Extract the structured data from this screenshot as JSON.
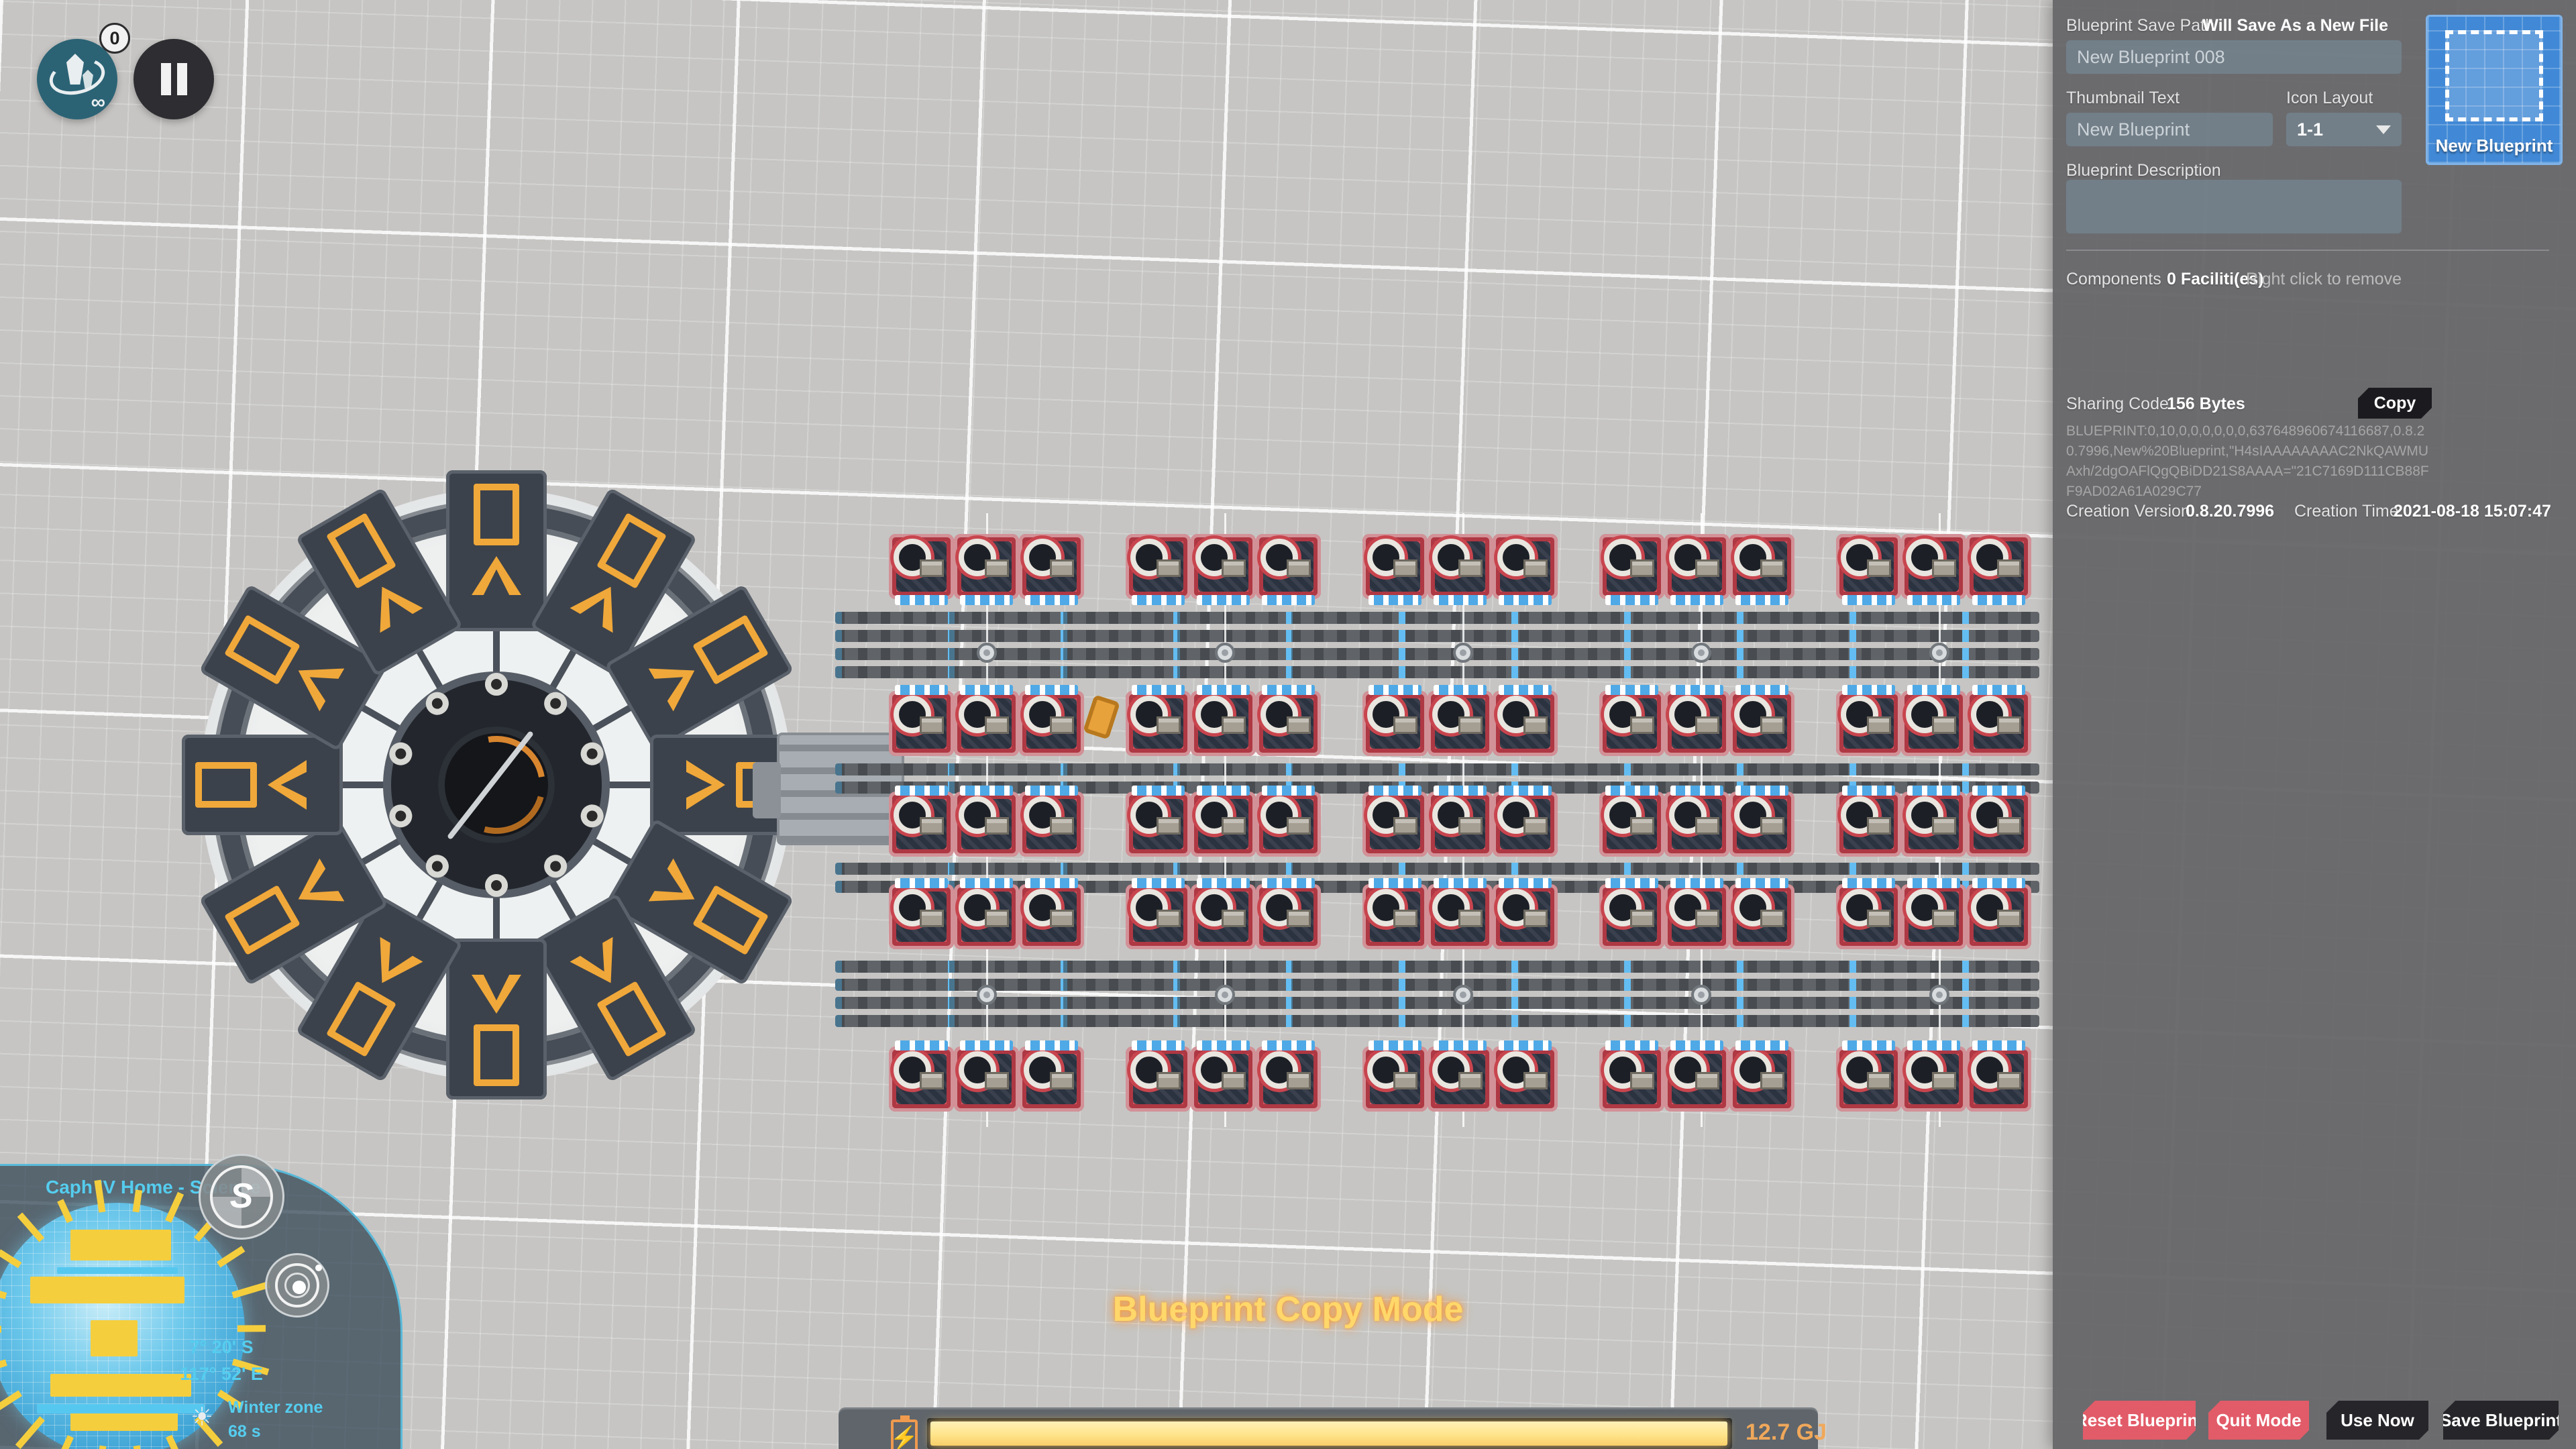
{
  "hud": {
    "recycle_badge": "0",
    "mode_title": "Blueprint Copy Mode",
    "energy_value": "12.7 GJ"
  },
  "minimap": {
    "title": "Caph IV Home - Science",
    "latitude": "7°  20'  S",
    "longitude": "117°  52'  E",
    "zone_label": "Winter zone",
    "zone_time": "68 s",
    "sun_icon": "☀"
  },
  "panel": {
    "save_path": {
      "label": "Blueprint Save Path",
      "status": "Will Save As a New File",
      "value": "New Blueprint 008"
    },
    "thumbnail_text": {
      "label": "Thumbnail Text",
      "value": "New Blueprint"
    },
    "icon_layout": {
      "label": "Icon Layout",
      "value": "1-1"
    },
    "description": {
      "label": "Blueprint Description",
      "value": ""
    },
    "components": {
      "label": "Components",
      "count": "0 Faciliti(es)",
      "hint": "Right click to remove"
    },
    "sharing": {
      "label": "Sharing Code",
      "size": "156 Bytes",
      "copy_label": "Copy",
      "code": "BLUEPRINT:0,10,0,0,0,0,0,0,637648960674116687,0.8.20.7996,New%20Blueprint,\"H4sIAAAAAAAAC2NkQAWMUAxh/2dgOAFlQgQBiDD21S8AAAA=\"21C7169D111CB88FF9AD02A61A029C77"
    },
    "creation": {
      "version_label": "Creation Version",
      "version": "0.8.20.7996",
      "time_label": "Creation Time",
      "time": "2021-08-18 15:07:47"
    },
    "thumbnail_caption": "New Blueprint",
    "actions": {
      "reset": "Reset Blueprint",
      "quit": "Quit Mode",
      "use": "Use Now",
      "save": "Save Blueprint"
    }
  },
  "colors": {
    "blueprint_blue": "#4189d6",
    "warning_red": "#e25b68",
    "dark_button": "#26262a",
    "energy_orange": "#f0a85a",
    "mode_gold": "#ffd76a",
    "hud_cyan": "#55cdef"
  },
  "scene": {
    "machine_rows": 5,
    "machine_groups_per_row": 5,
    "machines_per_group": 3,
    "ring_pads": 12,
    "hub_nodes": 10,
    "planet_spikes": 22
  }
}
